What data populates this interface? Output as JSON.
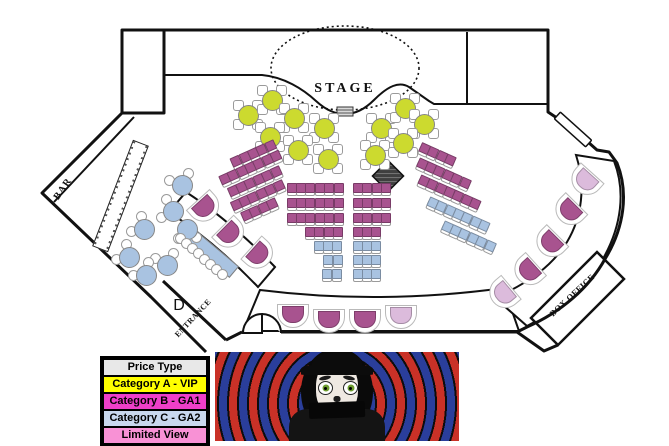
{
  "legend": {
    "header": {
      "label": "Price Type",
      "color": "#e8e8e8"
    },
    "rows": [
      {
        "label": "Category A - VIP",
        "color": "#ffff00"
      },
      {
        "label": "Category B - GA1",
        "color": "#ee3fc9"
      },
      {
        "label": "Category C - GA2",
        "color": "#c9d8ee"
      },
      {
        "label": "Limited View",
        "color": "#f891d5"
      }
    ],
    "x": 100,
    "y": 356
  },
  "venue": {
    "colors": {
      "vip": "#ccda2f",
      "ga1": "#a8538f",
      "ga2": "#a9c3e1",
      "limited": "#dcbbdc",
      "chair": "#ffffff",
      "wall": "#111111"
    },
    "labels": [
      {
        "id": "stage",
        "text": "STAGE",
        "x": 345,
        "y": 89,
        "rot": 0,
        "size": 14,
        "ls": 3
      },
      {
        "id": "bar",
        "text": "BAR",
        "x": 63,
        "y": 189,
        "rot": -55,
        "size": 10,
        "ls": 1
      },
      {
        "id": "entrance",
        "text": "ENTRANCE",
        "x": 193,
        "y": 318,
        "rot": -47,
        "size": 8,
        "ls": 0.5
      },
      {
        "id": "box-office",
        "text": "BOX OFFICE",
        "x": 572,
        "y": 295,
        "rot": -43,
        "size": 8.5,
        "ls": 0.5
      },
      {
        "id": "door-d",
        "text": "D",
        "x": 179,
        "y": 306,
        "rot": 0,
        "size": 16,
        "ls": 0,
        "plain": true
      }
    ],
    "round_tables": [
      {
        "x": 247,
        "y": 114,
        "t": "vip"
      },
      {
        "x": 271,
        "y": 99,
        "t": "vip"
      },
      {
        "x": 293,
        "y": 117,
        "t": "vip"
      },
      {
        "x": 269,
        "y": 136,
        "t": "vip"
      },
      {
        "x": 323,
        "y": 127,
        "t": "vip"
      },
      {
        "x": 297,
        "y": 149,
        "t": "vip"
      },
      {
        "x": 327,
        "y": 158,
        "t": "vip"
      },
      {
        "x": 380,
        "y": 127,
        "t": "vip"
      },
      {
        "x": 374,
        "y": 154,
        "t": "vip"
      },
      {
        "x": 404,
        "y": 107,
        "t": "vip"
      },
      {
        "x": 423,
        "y": 123,
        "t": "vip"
      },
      {
        "x": 402,
        "y": 142,
        "t": "vip"
      },
      {
        "x": 181,
        "y": 184,
        "t": "ga2",
        "chairs": [
          200,
          300
        ]
      },
      {
        "x": 172,
        "y": 210,
        "t": "ga2",
        "chairs": [
          150,
          240
        ]
      },
      {
        "x": 143,
        "y": 228,
        "t": "ga2",
        "chairs": [
          170,
          260
        ]
      },
      {
        "x": 186,
        "y": 228,
        "t": "ga2",
        "chairs": [
          40,
          130
        ]
      },
      {
        "x": 128,
        "y": 256,
        "t": "ga2",
        "chairs": [
          170,
          260
        ]
      },
      {
        "x": 166,
        "y": 264,
        "t": "ga2",
        "chairs": [
          210,
          300
        ]
      },
      {
        "x": 145,
        "y": 274,
        "t": "ga2",
        "chairs": [
          180,
          280
        ]
      }
    ],
    "seat_rows": [
      {
        "cx": 314,
        "cy": 187,
        "c": 6,
        "t": "ga1"
      },
      {
        "cx": 314,
        "cy": 202,
        "c": 6,
        "t": "ga1"
      },
      {
        "cx": 314,
        "cy": 217,
        "c": 6,
        "t": "ga1"
      },
      {
        "cx": 323,
        "cy": 231,
        "c": 4,
        "t": "ga1"
      },
      {
        "cx": 327,
        "cy": 245,
        "c": 3,
        "t": "ga2"
      },
      {
        "cx": 332,
        "cy": 259,
        "c": 2,
        "t": "ga2"
      },
      {
        "cx": 331,
        "cy": 273,
        "c": 2,
        "t": "ga2"
      },
      {
        "cx": 371,
        "cy": 187,
        "c": 4,
        "t": "ga1"
      },
      {
        "cx": 371,
        "cy": 202,
        "c": 4,
        "t": "ga1"
      },
      {
        "cx": 371,
        "cy": 217,
        "c": 4,
        "t": "ga1"
      },
      {
        "cx": 366,
        "cy": 231,
        "c": 3,
        "t": "ga1"
      },
      {
        "cx": 366,
        "cy": 245,
        "c": 3,
        "t": "ga2"
      },
      {
        "cx": 366,
        "cy": 259,
        "c": 3,
        "t": "ga2"
      },
      {
        "cx": 366,
        "cy": 273,
        "c": 3,
        "t": "ga2"
      },
      {
        "cx": 252,
        "cy": 153,
        "c": 5,
        "rot": -24,
        "t": "ga1"
      },
      {
        "cx": 249,
        "cy": 167,
        "c": 7,
        "rot": -24,
        "t": "ga1"
      },
      {
        "cx": 253,
        "cy": 181,
        "c": 6,
        "rot": -24,
        "t": "ga1"
      },
      {
        "cx": 256,
        "cy": 195,
        "c": 6,
        "rot": -24,
        "t": "ga1"
      },
      {
        "cx": 258,
        "cy": 209,
        "c": 4,
        "rot": -24,
        "t": "ga1"
      },
      {
        "cx": 437,
        "cy": 153,
        "c": 4,
        "rot": 24,
        "t": "ga1"
      },
      {
        "cx": 443,
        "cy": 172,
        "c": 6,
        "rot": 24,
        "t": "ga1"
      },
      {
        "cx": 449,
        "cy": 191,
        "c": 7,
        "rot": 24,
        "t": "ga1"
      },
      {
        "cx": 458,
        "cy": 213,
        "c": 7,
        "rot": 24,
        "t": "ga2"
      },
      {
        "cx": 468,
        "cy": 235,
        "c": 6,
        "rot": 24,
        "t": "ga2"
      }
    ],
    "booths": [
      {
        "x": 203,
        "y": 207,
        "rot": -42,
        "t": "ga1"
      },
      {
        "x": 228,
        "y": 233,
        "rot": -45,
        "t": "ga1"
      },
      {
        "x": 257,
        "y": 254,
        "rot": -48,
        "t": "ga1"
      },
      {
        "x": 292,
        "y": 313,
        "rot": 0,
        "t": "ga1"
      },
      {
        "x": 328,
        "y": 318,
        "rot": 0,
        "t": "ga1"
      },
      {
        "x": 364,
        "y": 318,
        "rot": 0,
        "t": "ga1"
      },
      {
        "x": 400,
        "y": 314,
        "rot": 0,
        "t": "limited"
      },
      {
        "x": 586,
        "y": 179,
        "rot": 42,
        "t": "limited"
      },
      {
        "x": 570,
        "y": 209,
        "rot": 45,
        "t": "ga1"
      },
      {
        "x": 551,
        "y": 241,
        "rot": 45,
        "t": "ga1"
      },
      {
        "x": 529,
        "y": 269,
        "rot": 48,
        "t": "ga1"
      },
      {
        "x": 504,
        "y": 292,
        "rot": 50,
        "t": "limited"
      }
    ],
    "banquette": {
      "x": 209,
      "y": 251,
      "w": 64,
      "h": 13,
      "rot": 40,
      "chairs": [
        [
          179,
          237
        ],
        [
          185,
          242
        ],
        [
          191,
          247
        ],
        [
          197,
          252
        ],
        [
          203,
          258
        ],
        [
          209,
          263
        ],
        [
          215,
          268
        ],
        [
          221,
          273
        ]
      ]
    }
  },
  "promo": {
    "red": "#c93127",
    "blue": "#2a3e9b",
    "bg": "#0d0d0d"
  }
}
